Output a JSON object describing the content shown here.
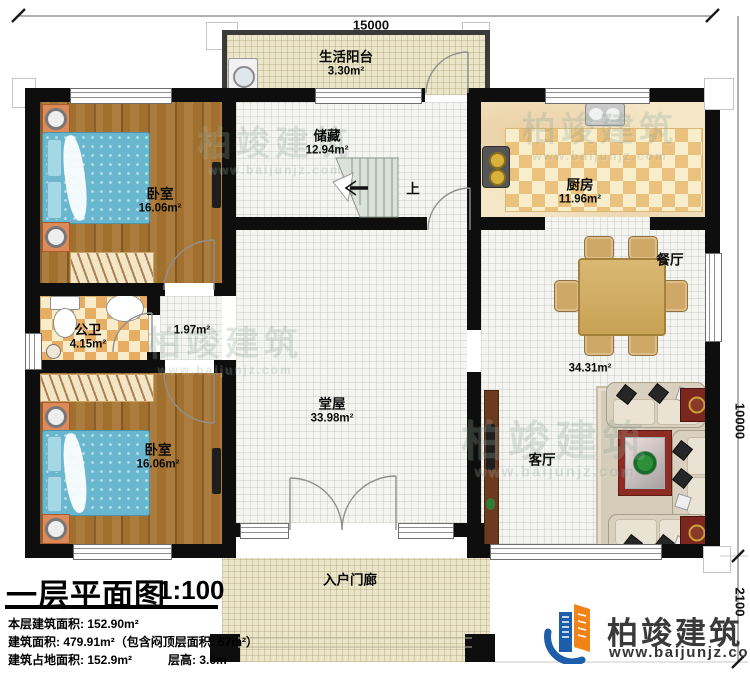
{
  "dimensions": {
    "top": "15000",
    "right_upper": "10000",
    "right_lower": "2100"
  },
  "rooms": {
    "balcony": {
      "name": "生活阳台",
      "area": "3.30m²"
    },
    "storage": {
      "name": "储藏",
      "area": "12.94m²"
    },
    "kitchen": {
      "name": "厨房",
      "area": "11.96m²"
    },
    "bedroom_top": {
      "name": "卧室",
      "area": "16.06m²"
    },
    "bathroom": {
      "name": "公卫",
      "area": "4.15m²"
    },
    "hallway": {
      "area": "1.97m²"
    },
    "bedroom_bottom": {
      "name": "卧室",
      "area": "16.06m²"
    },
    "main_hall": {
      "name": "堂屋",
      "area": "33.98m²"
    },
    "dining": {
      "name": "餐厅"
    },
    "living": {
      "name": "客厅",
      "area": "34.31m²"
    },
    "entrance_porch": {
      "name": "入户门廊"
    }
  },
  "stairs": {
    "up_label": "上"
  },
  "title_block": {
    "plan_name": "一层平面图",
    "scale": "1:100",
    "floor_area": "本层建筑面积: 152.90m²",
    "total_area": "建筑面积: 479.91m²（包含闷顶层面积: 57m²）",
    "footprint": "建筑占地面积: 152.9m²",
    "storey_height": "层高: 3.6m"
  },
  "logo": {
    "company": "柏竣建筑",
    "website": "www.baijunjz.com"
  },
  "watermark": {
    "text": "柏竣建筑",
    "website": "www.baijunjz.com"
  },
  "colors": {
    "wall": "#0e0e0e",
    "logo_blue": "#1c5eaa",
    "logo_orange": "#f08419",
    "wood_floor": "#a2702e",
    "tile_accent": "#e7ad62"
  }
}
